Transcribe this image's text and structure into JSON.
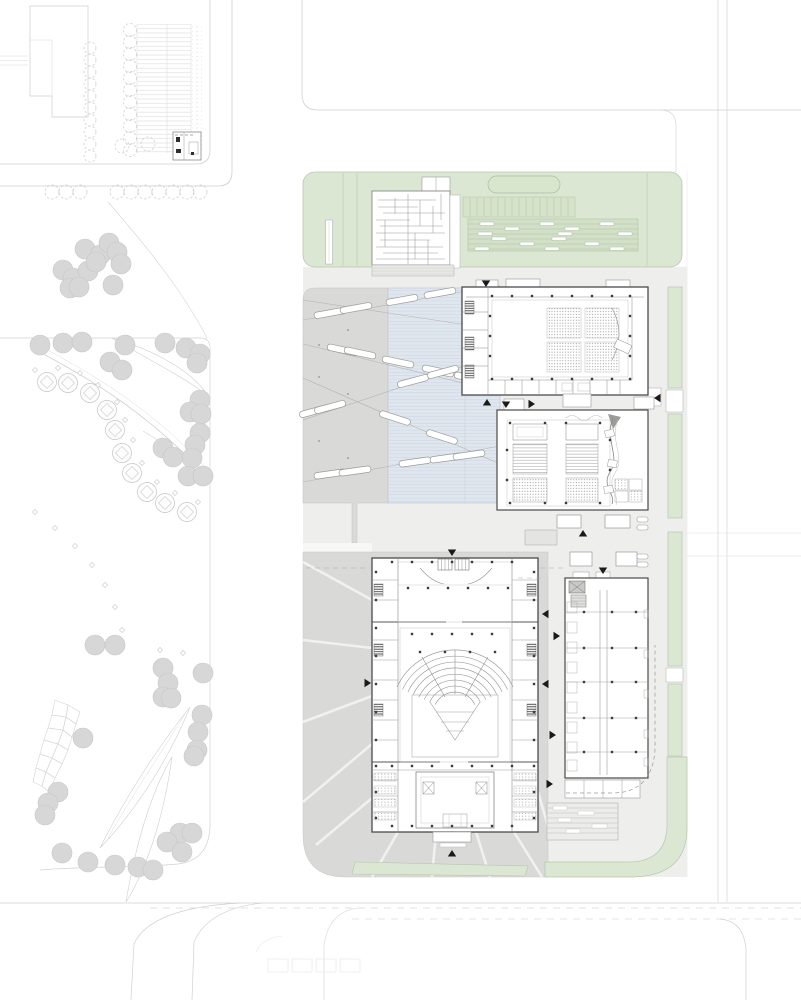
{
  "meta": {
    "drawing": "architectural-site-plan",
    "width": 801,
    "height": 1000
  },
  "colors": {
    "green": "#dbe7d2",
    "green_line": "#b7c7ae",
    "green_dark": "#d2e0c7",
    "capsule": "#d8e6cd",
    "water": "#e0e6ee",
    "water_line": "#ccd4e1",
    "water_edge": "#b9c2cf",
    "plaza": "#d9d9d7",
    "plaza_line": "#c2c2c0",
    "ground": "#eeeeed",
    "wall": "#4a4a4a",
    "wall_light": "#8c8c8c",
    "draw": "#9a9a9a",
    "road": "#cfcfcf",
    "faint": "#e2e2e0",
    "tree": "#d7d7d7",
    "tree_edge": "#c6c6c6",
    "park_line": "#cfcfcf",
    "arrow": "#1a1a1a",
    "white": "#ffffff"
  },
  "park": {
    "filled_trees": [
      [
        85,
        249
      ],
      [
        100,
        255
      ],
      [
        109,
        243
      ],
      [
        117,
        252
      ],
      [
        121,
        264
      ],
      [
        63,
        270
      ],
      [
        73,
        278
      ],
      [
        88,
        271
      ],
      [
        70,
        288
      ],
      [
        79,
        287
      ],
      [
        113,
        285
      ],
      [
        96,
        262
      ],
      [
        40,
        345
      ],
      [
        63,
        343
      ],
      [
        82,
        342
      ],
      [
        125,
        345
      ],
      [
        110,
        362
      ],
      [
        122,
        370
      ],
      [
        165,
        343
      ],
      [
        186,
        348
      ],
      [
        200,
        354
      ],
      [
        197,
        363
      ],
      [
        200,
        400
      ],
      [
        190,
        412
      ],
      [
        201,
        414
      ],
      [
        200,
        433
      ],
      [
        195,
        445
      ],
      [
        163,
        448
      ],
      [
        173,
        457
      ],
      [
        192,
        458
      ],
      [
        188,
        476
      ],
      [
        203,
        476
      ],
      [
        95,
        645
      ],
      [
        115,
        645
      ],
      [
        163,
        668
      ],
      [
        203,
        673
      ],
      [
        168,
        683
      ],
      [
        163,
        697
      ],
      [
        171,
        698
      ],
      [
        202,
        715
      ],
      [
        198,
        732
      ],
      [
        197,
        750
      ],
      [
        194,
        756
      ],
      [
        83,
        738
      ],
      [
        58,
        792
      ],
      [
        48,
        803
      ],
      [
        45,
        815
      ],
      [
        62,
        853
      ],
      [
        88,
        862
      ],
      [
        115,
        865
      ],
      [
        138,
        867
      ],
      [
        153,
        870
      ],
      [
        180,
        833
      ],
      [
        167,
        842
      ],
      [
        182,
        852
      ],
      [
        192,
        833
      ]
    ],
    "square_trees": [
      [
        47,
        382
      ],
      [
        68,
        383
      ],
      [
        90,
        393
      ],
      [
        107,
        410
      ],
      [
        115,
        430
      ],
      [
        122,
        453
      ],
      [
        132,
        473
      ],
      [
        147,
        492
      ],
      [
        165,
        503
      ],
      [
        187,
        512
      ]
    ],
    "diamonds": [
      [
        35,
        370
      ],
      [
        58,
        368
      ],
      [
        80,
        373
      ],
      [
        98,
        385
      ],
      [
        117,
        402
      ],
      [
        125,
        420
      ],
      [
        133,
        440
      ],
      [
        142,
        463
      ],
      [
        157,
        482
      ],
      [
        175,
        493
      ],
      [
        198,
        502
      ],
      [
        35,
        512
      ],
      [
        55,
        528
      ],
      [
        75,
        546
      ],
      [
        92,
        565
      ],
      [
        105,
        585
      ],
      [
        115,
        607
      ],
      [
        122,
        630
      ],
      [
        160,
        650
      ],
      [
        183,
        653
      ]
    ],
    "street_trees_y": 192,
    "street_trees_x": [
      52,
      66,
      80,
      117,
      131,
      145,
      159,
      173,
      187,
      200
    ],
    "voronoi": [
      [
        55,
        700,
        68,
        705,
        66,
        717,
        52,
        715
      ],
      [
        68,
        705,
        80,
        712,
        76,
        724,
        66,
        717
      ],
      [
        52,
        715,
        66,
        717,
        63,
        730,
        48,
        728
      ],
      [
        66,
        717,
        76,
        724,
        72,
        737,
        63,
        730
      ],
      [
        48,
        728,
        63,
        730,
        58,
        744,
        44,
        740
      ],
      [
        63,
        730,
        72,
        737,
        68,
        750,
        58,
        744
      ],
      [
        44,
        740,
        58,
        744,
        52,
        758,
        40,
        754
      ],
      [
        58,
        744,
        68,
        750,
        62,
        764,
        52,
        758
      ],
      [
        40,
        754,
        52,
        758,
        46,
        772,
        36,
        768
      ],
      [
        52,
        758,
        62,
        764,
        55,
        778,
        46,
        772
      ],
      [
        36,
        768,
        46,
        772,
        42,
        786,
        33,
        782
      ],
      [
        46,
        772,
        55,
        778,
        49,
        792,
        42,
        786
      ]
    ]
  },
  "parking": {
    "col_a_x": 90,
    "col_a_y": [
      48,
      60,
      72,
      84,
      96,
      108,
      120,
      132,
      144,
      156
    ],
    "col_b_x": 130,
    "col_b_y": [
      30,
      42,
      54,
      66,
      78,
      90,
      102,
      114,
      126,
      138,
      150
    ],
    "extra": [
      [
        122,
        146
      ],
      [
        148,
        144
      ]
    ]
  },
  "skylights": {
    "lines": [
      [
        303,
        320,
        500,
        285
      ],
      [
        303,
        344,
        500,
        392
      ],
      [
        303,
        420,
        500,
        354
      ],
      [
        303,
        378,
        500,
        464
      ],
      [
        303,
        482,
        500,
        446
      ],
      [
        303,
        300,
        500,
        330
      ]
    ],
    "bars": [
      [
        330,
        313,
        -10
      ],
      [
        356,
        308,
        -10
      ],
      [
        402,
        300,
        -10
      ],
      [
        440,
        293,
        -10
      ],
      [
        343,
        350,
        12
      ],
      [
        360,
        353,
        12
      ],
      [
        398,
        362,
        12
      ],
      [
        438,
        371,
        12
      ],
      [
        470,
        378,
        12
      ],
      [
        315,
        411,
        -15
      ],
      [
        330,
        407,
        -15
      ],
      [
        413,
        381,
        -15
      ],
      [
        443,
        372,
        -15
      ],
      [
        395,
        418,
        18
      ],
      [
        442,
        437,
        18
      ],
      [
        330,
        474,
        -8
      ],
      [
        355,
        471,
        -8
      ],
      [
        415,
        462,
        -8
      ],
      [
        446,
        458,
        -8
      ],
      [
        469,
        455,
        -8
      ]
    ]
  },
  "plaza": {
    "dot_columns": [
      {
        "x": 319,
        "ys": [
          313,
          345,
          377,
          409,
          441,
          473
        ]
      },
      {
        "x": 348,
        "ys": [
          330,
          394,
          458
        ]
      }
    ]
  },
  "roof_garden": {
    "stripe_x_start": 470,
    "stripe_x_end": 568,
    "stripe_step": 7,
    "stripe_y1": 198,
    "stripe_y2": 216,
    "terrace_seats": [
      [
        480,
        222
      ],
      [
        540,
        222
      ],
      [
        600,
        222
      ],
      [
        505,
        227
      ],
      [
        565,
        227
      ],
      [
        478,
        232
      ],
      [
        558,
        232
      ],
      [
        618,
        232
      ],
      [
        492,
        237
      ],
      [
        552,
        237
      ],
      [
        520,
        242
      ],
      [
        585,
        242
      ],
      [
        475,
        247
      ],
      [
        545,
        247
      ],
      [
        610,
        247
      ]
    ]
  },
  "green_strips": {
    "rects": [
      [
        668,
        287,
        14,
        101
      ],
      [
        668,
        414,
        14,
        104
      ],
      [
        668,
        532,
        14,
        134
      ],
      [
        668,
        684,
        14,
        72
      ]
    ],
    "gap_boxes": [
      [
        666,
        390,
        17,
        22
      ],
      [
        666,
        668,
        17,
        14
      ]
    ]
  },
  "service": {
    "boxes": [
      [
        557,
        515,
        24,
        13
      ],
      [
        605,
        515,
        25,
        13
      ],
      [
        570,
        552,
        22,
        14
      ],
      [
        616,
        552,
        21,
        14
      ]
    ],
    "pills": [
      [
        637,
        517,
        11,
        5
      ],
      [
        637,
        525,
        11,
        5
      ],
      [
        637,
        554,
        11,
        5
      ],
      [
        637,
        562,
        11,
        5
      ]
    ]
  },
  "arrows": [
    {
      "x": 486,
      "y": 287,
      "d": "down"
    },
    {
      "x": 452,
      "y": 556,
      "d": "down"
    },
    {
      "x": 506,
      "y": 408,
      "d": "down"
    },
    {
      "x": 603,
      "y": 574,
      "d": "down"
    },
    {
      "x": 487,
      "y": 399,
      "d": "up"
    },
    {
      "x": 583,
      "y": 530,
      "d": "up"
    },
    {
      "x": 452,
      "y": 850,
      "d": "up"
    },
    {
      "x": 654,
      "y": 398,
      "d": "left"
    },
    {
      "x": 542,
      "y": 614,
      "d": "left"
    },
    {
      "x": 542,
      "y": 684,
      "d": "left"
    },
    {
      "x": 535,
      "y": 404,
      "d": "right"
    },
    {
      "x": 560,
      "y": 636,
      "d": "right"
    },
    {
      "x": 556,
      "y": 735,
      "d": "right"
    },
    {
      "x": 553,
      "y": 784,
      "d": "right"
    },
    {
      "x": 371,
      "y": 683,
      "d": "right"
    }
  ],
  "columns": [
    [
      492,
      296
    ],
    [
      512,
      296
    ],
    [
      532,
      296
    ],
    [
      552,
      296
    ],
    [
      572,
      296
    ],
    [
      592,
      296
    ],
    [
      612,
      296
    ],
    [
      630,
      296
    ],
    [
      492,
      379
    ],
    [
      512,
      379
    ],
    [
      532,
      379
    ],
    [
      552,
      379
    ],
    [
      572,
      379
    ],
    [
      592,
      379
    ],
    [
      612,
      379
    ],
    [
      630,
      379
    ],
    [
      490,
      316
    ],
    [
      490,
      336
    ],
    [
      490,
      356
    ],
    [
      630,
      316
    ],
    [
      630,
      336
    ],
    [
      630,
      356
    ],
    [
      510,
      423
    ],
    [
      545,
      423
    ],
    [
      566,
      423
    ],
    [
      600,
      423
    ],
    [
      510,
      503
    ],
    [
      545,
      503
    ],
    [
      566,
      503
    ],
    [
      600,
      503
    ],
    [
      610,
      440
    ],
    [
      610,
      470
    ],
    [
      507,
      450
    ],
    [
      507,
      480
    ],
    [
      392,
      562
    ],
    [
      412,
      562
    ],
    [
      432,
      562
    ],
    [
      452,
      562
    ],
    [
      472,
      562
    ],
    [
      492,
      562
    ],
    [
      512,
      562
    ],
    [
      392,
      826
    ],
    [
      412,
      826
    ],
    [
      432,
      826
    ],
    [
      452,
      826
    ],
    [
      472,
      826
    ],
    [
      492,
      826
    ],
    [
      512,
      826
    ],
    [
      376,
      572
    ],
    [
      376,
      600
    ],
    [
      376,
      628
    ],
    [
      376,
      656
    ],
    [
      376,
      684
    ],
    [
      376,
      712
    ],
    [
      376,
      740
    ],
    [
      376,
      766
    ],
    [
      376,
      792
    ],
    [
      376,
      818
    ],
    [
      534,
      572
    ],
    [
      534,
      600
    ],
    [
      534,
      628
    ],
    [
      534,
      656
    ],
    [
      534,
      684
    ],
    [
      534,
      712
    ],
    [
      534,
      740
    ],
    [
      534,
      766
    ],
    [
      534,
      792
    ],
    [
      534,
      818
    ],
    [
      408,
      588
    ],
    [
      428,
      588
    ],
    [
      448,
      588
    ],
    [
      468,
      588
    ],
    [
      488,
      588
    ],
    [
      508,
      588
    ],
    [
      412,
      634
    ],
    [
      432,
      634
    ],
    [
      452,
      634
    ],
    [
      472,
      634
    ],
    [
      492,
      634
    ],
    [
      420,
      652
    ],
    [
      445,
      652
    ],
    [
      470,
      652
    ],
    [
      495,
      652
    ],
    [
      392,
      766
    ],
    [
      412,
      766
    ],
    [
      432,
      766
    ],
    [
      452,
      766
    ],
    [
      472,
      766
    ],
    [
      492,
      766
    ],
    [
      512,
      766
    ],
    [
      584,
      612
    ],
    [
      612,
      612
    ],
    [
      636,
      612
    ],
    [
      584,
      648
    ],
    [
      612,
      648
    ],
    [
      636,
      648
    ],
    [
      584,
      682
    ],
    [
      612,
      682
    ],
    [
      636,
      682
    ],
    [
      584,
      718
    ],
    [
      612,
      718
    ],
    [
      636,
      718
    ],
    [
      584,
      752
    ],
    [
      612,
      752
    ],
    [
      636,
      752
    ]
  ]
}
